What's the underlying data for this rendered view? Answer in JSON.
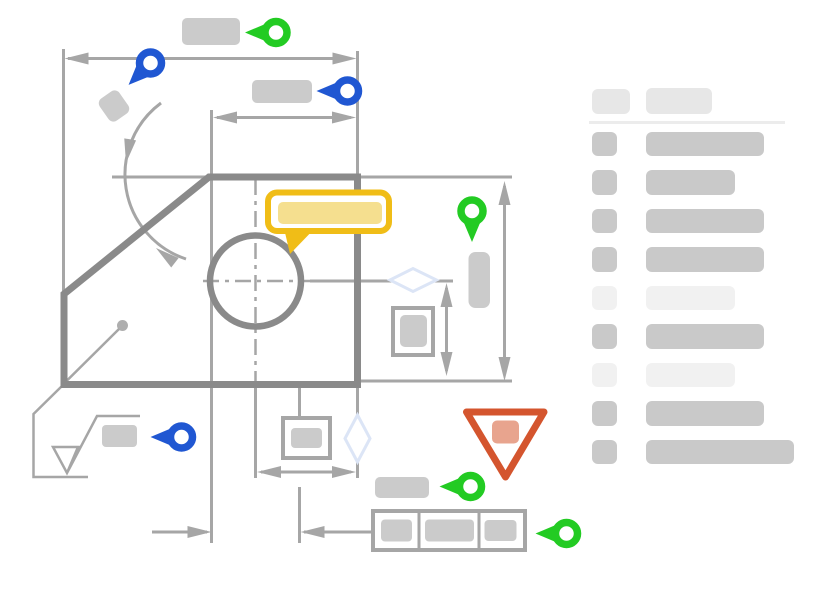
{
  "canvas": {
    "width": 827,
    "height": 591,
    "background": "#ffffff"
  },
  "colors": {
    "accent_green": "#23cb23",
    "accent_blue": "#2057d2",
    "accent_yellow": "#f0bd17",
    "accent_yellow_fill": "#f5df8f",
    "accent_red": "#d4552e",
    "accent_red_fill": "#e8a48e",
    "outline_dark": "#8a8a8a",
    "line_gray": "#a6a6a6",
    "placeholder_gray": "#cbcbcb",
    "placeholder_light": "#f1f1f1",
    "panel_row_gray": "#c9c9c9",
    "panel_header_gray": "#e7e7e7",
    "divider_gray": "#ececec",
    "diamond_blue": "#dce5f6"
  },
  "annotation_pins": [
    {
      "id": "pin-green-top-dimension",
      "color": "green",
      "direction": "left",
      "x": 276,
      "y": 32.5
    },
    {
      "id": "pin-blue-angle",
      "color": "blue",
      "direction": "down-left",
      "x": 150.5,
      "y": 63
    },
    {
      "id": "pin-blue-width-dimension",
      "color": "blue",
      "direction": "left",
      "x": 347.5,
      "y": 91
    },
    {
      "id": "pin-green-height-dimension",
      "color": "green",
      "direction": "down",
      "x": 472,
      "y": 211
    },
    {
      "id": "pin-blue-surface-finish",
      "color": "blue",
      "direction": "left",
      "x": 181.5,
      "y": 437
    },
    {
      "id": "pin-green-datum",
      "color": "green",
      "direction": "left",
      "x": 470.5,
      "y": 486.5
    },
    {
      "id": "pin-green-control-frame",
      "color": "green",
      "direction": "left",
      "x": 566.5,
      "y": 533.5
    }
  ],
  "legend_panel": {
    "header": {
      "badge_width": 38,
      "title_width": 66
    },
    "rows": [
      {
        "tone": "medium",
        "bar_width": 118
      },
      {
        "tone": "medium",
        "bar_width": 89
      },
      {
        "tone": "medium",
        "bar_width": 118
      },
      {
        "tone": "medium",
        "bar_width": 118
      },
      {
        "tone": "light",
        "bar_width": 89
      },
      {
        "tone": "medium",
        "bar_width": 118
      },
      {
        "tone": "light",
        "bar_width": 89
      },
      {
        "tone": "medium",
        "bar_width": 118
      },
      {
        "tone": "medium",
        "bar_width": 148
      }
    ]
  }
}
